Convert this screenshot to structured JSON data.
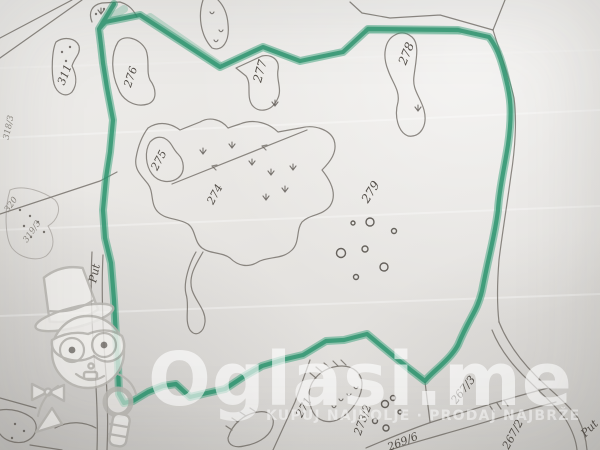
{
  "watermark": {
    "brand": "Oglasi.me",
    "tagline": "KUPUJ NAJBOLJE · PRODAJ NAJBRŽE"
  },
  "map": {
    "highlight_color": "#2f9c74",
    "line_color": "#6a645e",
    "paper_color": "#e8e6e3",
    "labels": [
      "311",
      "276",
      "277",
      "278",
      "275",
      "274",
      "279",
      "271",
      "273/2",
      "269/6",
      "267/3",
      "267/2",
      "318/3",
      "320",
      "319/3",
      "Put",
      "Put"
    ]
  }
}
